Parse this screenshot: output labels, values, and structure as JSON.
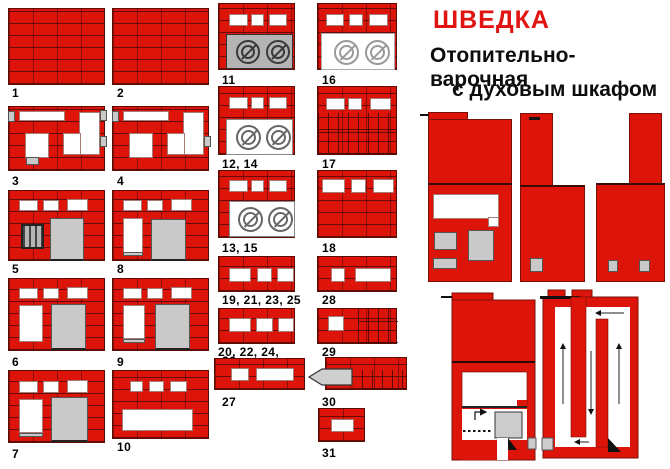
{
  "title": {
    "name": "ШВЕДКА",
    "subtitle1": "Отопительно-варочная",
    "subtitle2": "с духовым шкафом"
  },
  "labels": {
    "r1": "1",
    "r2": "2",
    "r3": "3",
    "r4": "4",
    "r5": "5",
    "r6": "6",
    "r7": "7",
    "r8": "8",
    "r9": "9",
    "r10": "10",
    "r11": "11",
    "r12_14": "12, 14",
    "r13_15": "13, 15",
    "r16": "16",
    "r17": "17",
    "r18": "18",
    "r19": "19, 21, 23, 25",
    "r20": "20, 22, 24,",
    "r20b": "26",
    "r27": "27",
    "r28": "28",
    "r29": "29",
    "r30": "30",
    "r31": "31"
  },
  "colors": {
    "brick_red": "#dc140a",
    "title_red": "#e01410",
    "metal_gray": "#c9c9c9",
    "plate_gray": "#b4b4b4",
    "text_black": "#0d0d0d"
  }
}
